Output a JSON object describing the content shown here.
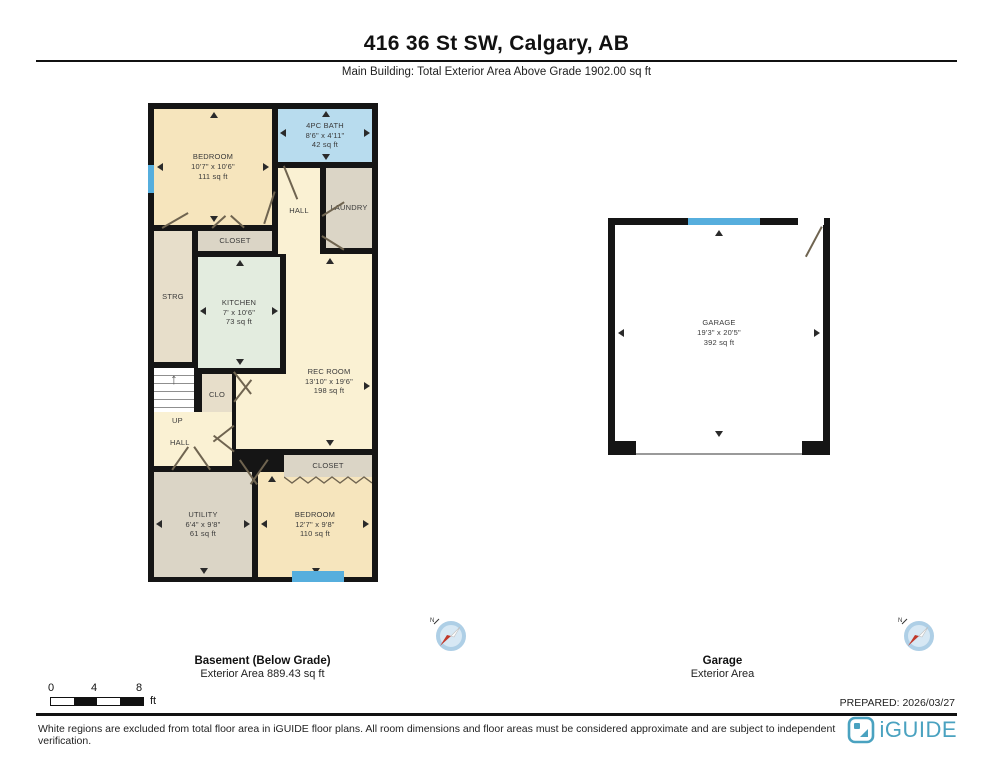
{
  "header": {
    "title": "416 36 St SW, Calgary, AB",
    "subtitle": "Main Building: Total Exterior Area Above Grade 1902.00 sq ft"
  },
  "basement": {
    "caption_title": "Basement (Below Grade)",
    "caption_subtitle": "Exterior Area 889.43 sq ft",
    "rooms": {
      "bedroom1": {
        "name": "BEDROOM",
        "dims": "10'7\" x 10'6\"",
        "area": "111 sq ft"
      },
      "bath": {
        "name": "4PC BATH",
        "dims": "8'6\" x 4'11\"",
        "area": "42 sq ft"
      },
      "laundry": {
        "name": "LAUNDRY"
      },
      "hall_upper": {
        "name": "HALL"
      },
      "closet_upper": {
        "name": "CLOSET"
      },
      "strg": {
        "name": "STRG"
      },
      "kitchen": {
        "name": "KITCHEN",
        "dims": "7' x 10'6\"",
        "area": "73 sq ft"
      },
      "rec_room": {
        "name": "REC ROOM",
        "dims": "13'10\" x 19'6\"",
        "area": "198 sq ft"
      },
      "clo": {
        "name": "CLO"
      },
      "up": {
        "name": "UP"
      },
      "hall_lower": {
        "name": "HALL"
      },
      "utility": {
        "name": "UTILITY",
        "dims": "6'4\" x 9'8\"",
        "area": "61 sq ft"
      },
      "bedroom2": {
        "name": "BEDROOM",
        "dims": "12'7\" x 9'8\"",
        "area": "110 sq ft"
      },
      "closet_lower": {
        "name": "CLOSET"
      }
    }
  },
  "garage_plan": {
    "caption_title": "Garage",
    "caption_subtitle": "Exterior Area",
    "room": {
      "name": "GARAGE",
      "dims": "19'3\" x 20'5\"",
      "area": "392 sq ft"
    }
  },
  "compass": {
    "north_label": "N"
  },
  "scale_bar": {
    "tick0": "0",
    "tick4": "4",
    "tick8": "8",
    "unit": "ft"
  },
  "prepared_label": "PREPARED: 2026/03/27",
  "footer": {
    "disclaimer": "White regions are excluded from total floor area in iGUIDE floor plans. All room dimensions and floor areas must be considered approximate and are subject to independent verification.",
    "brand": "iGUIDE"
  },
  "colors": {
    "wall": "#151515",
    "room-beige": "#f6e5bd",
    "room-cream": "#faf1d3",
    "room-gray": "#dbd5c6",
    "room-tan": "#e7deca",
    "room-green": "#e3ecdf",
    "room-blue": "#b8dcee",
    "window-blue": "#56aedd",
    "brand-teal": "#4aa2c0",
    "compass-red": "#c0392b"
  }
}
